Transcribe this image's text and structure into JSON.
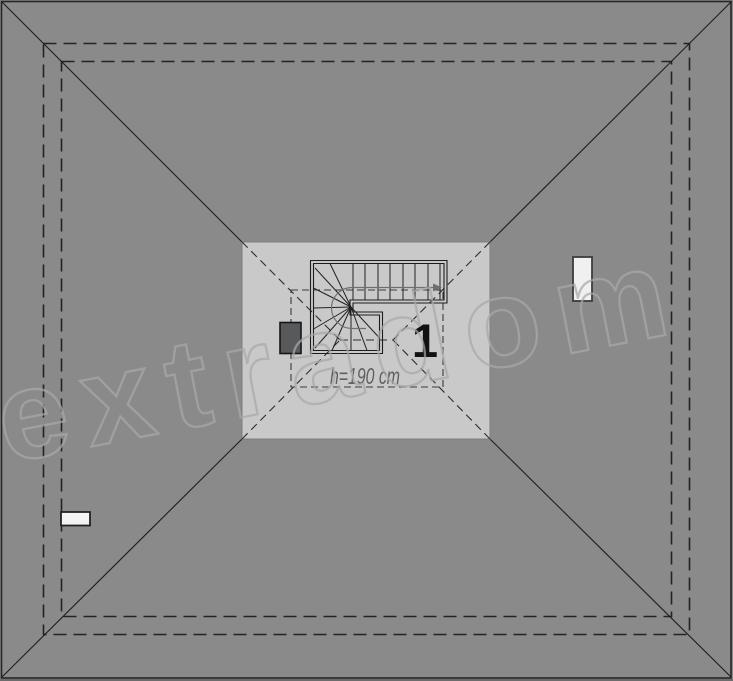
{
  "plan": {
    "room_number": "1",
    "height_label": "h=190 cm",
    "colors": {
      "roof_surface": "#8a8a8a",
      "attic_room_fill": "#c9c9c9",
      "plan_lines": "#1e1e1e",
      "hidden_dashed_lines": "#2d2d2d",
      "chimney_fill": "#58595a",
      "roof_window_fill": "#f0f0f0",
      "bottom_strip": "#6c6c6c",
      "height_label_color": "#5f5f5f"
    }
  },
  "watermark": {
    "text": "extradom",
    "color": "#a9a9a9"
  }
}
